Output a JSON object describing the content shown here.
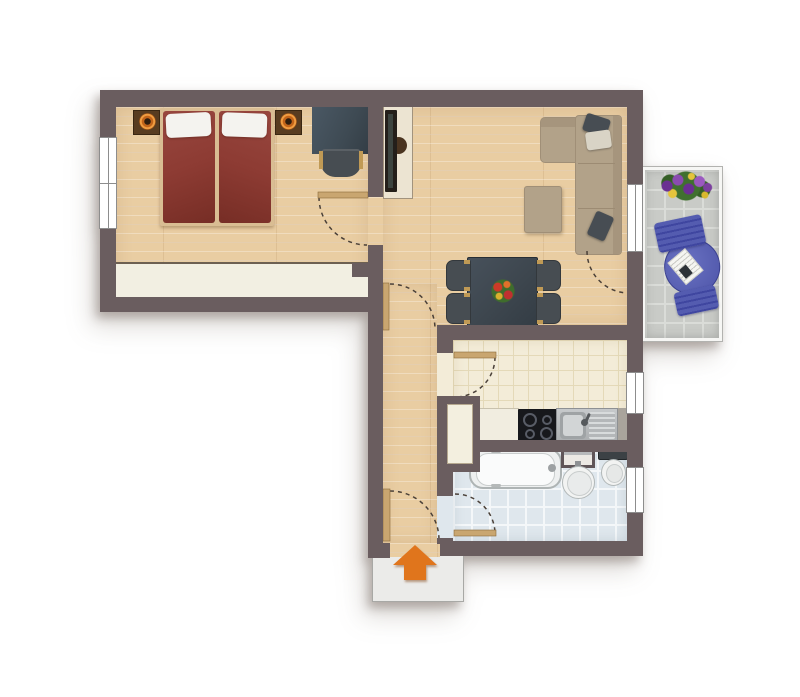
{
  "meta": {
    "type": "apartment-floor-plan",
    "view": "top-down",
    "description": "Color floor plan of a 2-room apartment with bedroom, living/dining room, hallway, kitchen, bathroom and balcony; orange arrow marks the entrance at the bottom"
  },
  "rooms": [
    {
      "name": "bedroom",
      "position": "top-left",
      "floor": "wood",
      "furniture": [
        "double-bed",
        "pillows",
        "nightstand-left",
        "nightstand-right",
        "bedside-lamp-left",
        "bedside-lamp-right",
        "desk",
        "desk-chair",
        "built-in-wardrobe"
      ]
    },
    {
      "name": "living-dining-room",
      "position": "top-right",
      "floor": "wood",
      "furniture": [
        "tv-board",
        "wall-tv",
        "corner-sofa",
        "sofa-cushion-dark-top",
        "sofa-cushion-light",
        "sofa-cushion-dark-bottom",
        "ottoman",
        "dining-table",
        "dining-chair x4",
        "flower-centerpiece"
      ]
    },
    {
      "name": "hallway",
      "position": "center-vertical",
      "floor": "wood",
      "furniture": []
    },
    {
      "name": "kitchen",
      "position": "right-middle",
      "floor": "cream-tile",
      "furniture": [
        "built-in-cupboard",
        "worktop",
        "cooktop-4-burners",
        "sink-with-drainer"
      ]
    },
    {
      "name": "bathroom",
      "position": "bottom-right",
      "floor": "blue-tile",
      "furniture": [
        "bathtub",
        "bath-cabinet",
        "round-washbasin",
        "toilet"
      ]
    },
    {
      "name": "balcony",
      "position": "right-outside",
      "floor": "grey-tile",
      "furniture": [
        "sun-lounger",
        "newspaper",
        "flower-box"
      ]
    }
  ],
  "openings": {
    "windows": [
      "bedroom-window-left",
      "balcony-door-window",
      "kitchen-window",
      "bathroom-window"
    ],
    "doors": [
      "bedroom-door",
      "living-room-door",
      "kitchen-door",
      "bathroom-door",
      "entrance-door",
      "balcony-door"
    ]
  },
  "entrance": {
    "marker": "orange-arrow",
    "direction": "up-into-apartment"
  },
  "colors": {
    "wall": "#6a5d5f",
    "wood": "#e9cda2",
    "wood_line": "rgba(165,115,60,.22)",
    "kitchen_floor": "#f3ecd8",
    "kitchen_line": "#e4d9b8",
    "bath_floor": "#dfe7ed",
    "bath_line": "#f4f7f9",
    "balcony_tile": "#c9cbc7",
    "balcony_line": "#dadcd8",
    "bed_red": "#8d3b33",
    "bed_red_dark": "#762d25",
    "pillow_white": "#f4f3ef",
    "frame_tan": "#d9bd93",
    "wardrobe_cream": "#f2efe2",
    "nightstand_brown": "#583c20",
    "lamp_orange": "#e0801f",
    "desk_slate": "#3e4a53",
    "chair_gray": "#474d52",
    "wood_accent": "#c09a55",
    "tv_board_cream": "#ece4d2",
    "tv_black": "#241f1a",
    "sofa_beige": "#b2a289",
    "sofa_seam": "#9c8b73",
    "cushion_dark": "#474d53",
    "cushion_light": "#d9d4c6",
    "table_slate": "#3d464e",
    "steel": "#b9bcbe",
    "steel_dark": "#8e9194",
    "cooktop_black": "#17181c",
    "fixture_white": "#f2f3f2",
    "fixture_line": "#b2b8b8",
    "porcelain_inner": "#e9ebeb",
    "door_leaf": "#c9a670",
    "arc_color": "#4a4038",
    "window_line": "#8d8d8d",
    "arrow_orange": "#e0751c",
    "platform_gray": "#ebebe9",
    "lounger_blue": "#5a61b4",
    "lounger_dark": "#3f46a0",
    "niche_cream": "#f3efdf",
    "cabinet_frame": "#5f5558"
  }
}
